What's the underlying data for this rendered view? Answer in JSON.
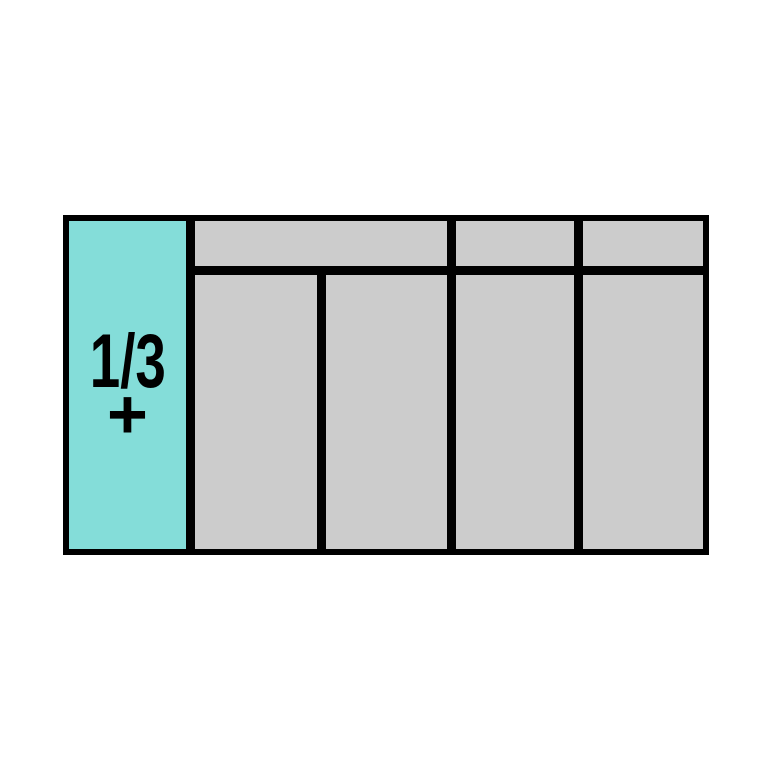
{
  "module_diagram": {
    "label": {
      "fraction": "1/3",
      "plus": "+"
    },
    "colors": {
      "background": "#ffffff",
      "outline": "#000000",
      "label_cell": "#84ddd9",
      "slot_cell": "#cccccc",
      "text": "#000000"
    },
    "structure": {
      "label_column_count": 1,
      "top_row_slot_count": 3,
      "bottom_row_slot_count": 4
    }
  }
}
